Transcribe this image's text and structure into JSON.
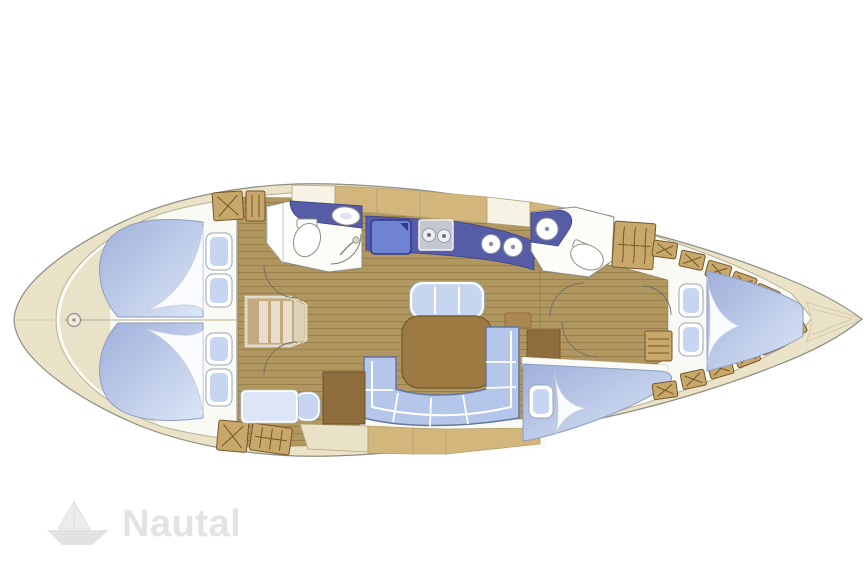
{
  "watermark": {
    "icon": "paper-boat-icon",
    "text": "Nautal"
  },
  "colors": {
    "page-bg": "#ffffff",
    "hull-fill": "#eae3c8",
    "hull-line": "#8d8d82",
    "lens-fill": "#fafaf4",
    "lens-line": "#b9b194",
    "deck-cream": "#e9e2c9",
    "deck-khaki": "#d3b67c",
    "cell-line": "#b3a474",
    "wood": "#b0965f",
    "wood-line": "#9a7f49",
    "cabinet": "#c8a76b",
    "cabinet-line": "#77552c",
    "navy": "#565da6",
    "navy-line": "#39408a",
    "fridge": "#6f83d2",
    "stove": "#c3c7cf",
    "bed-dark": "#9fb0da",
    "bed-light": "#dce6f7",
    "bed-line": "#8e9cc0",
    "sail": "#f9fbfe",
    "sail-line": "#c6cdd9",
    "pillow": "#c7d6f0",
    "sofa": "#b4c6e9",
    "sofa-line": "#65779f",
    "table": "#9c7a42",
    "table-line": "#7b6030",
    "desk": "#8d6d3b",
    "steps": "#c4aa7e",
    "steps-line": "#b3a07c",
    "white-room": "#fcfcf8",
    "wall": "#8a8a80",
    "fixture-line": "#8f8f8a",
    "arc": "#6f6f65",
    "watermark": "#e3e3e3"
  }
}
